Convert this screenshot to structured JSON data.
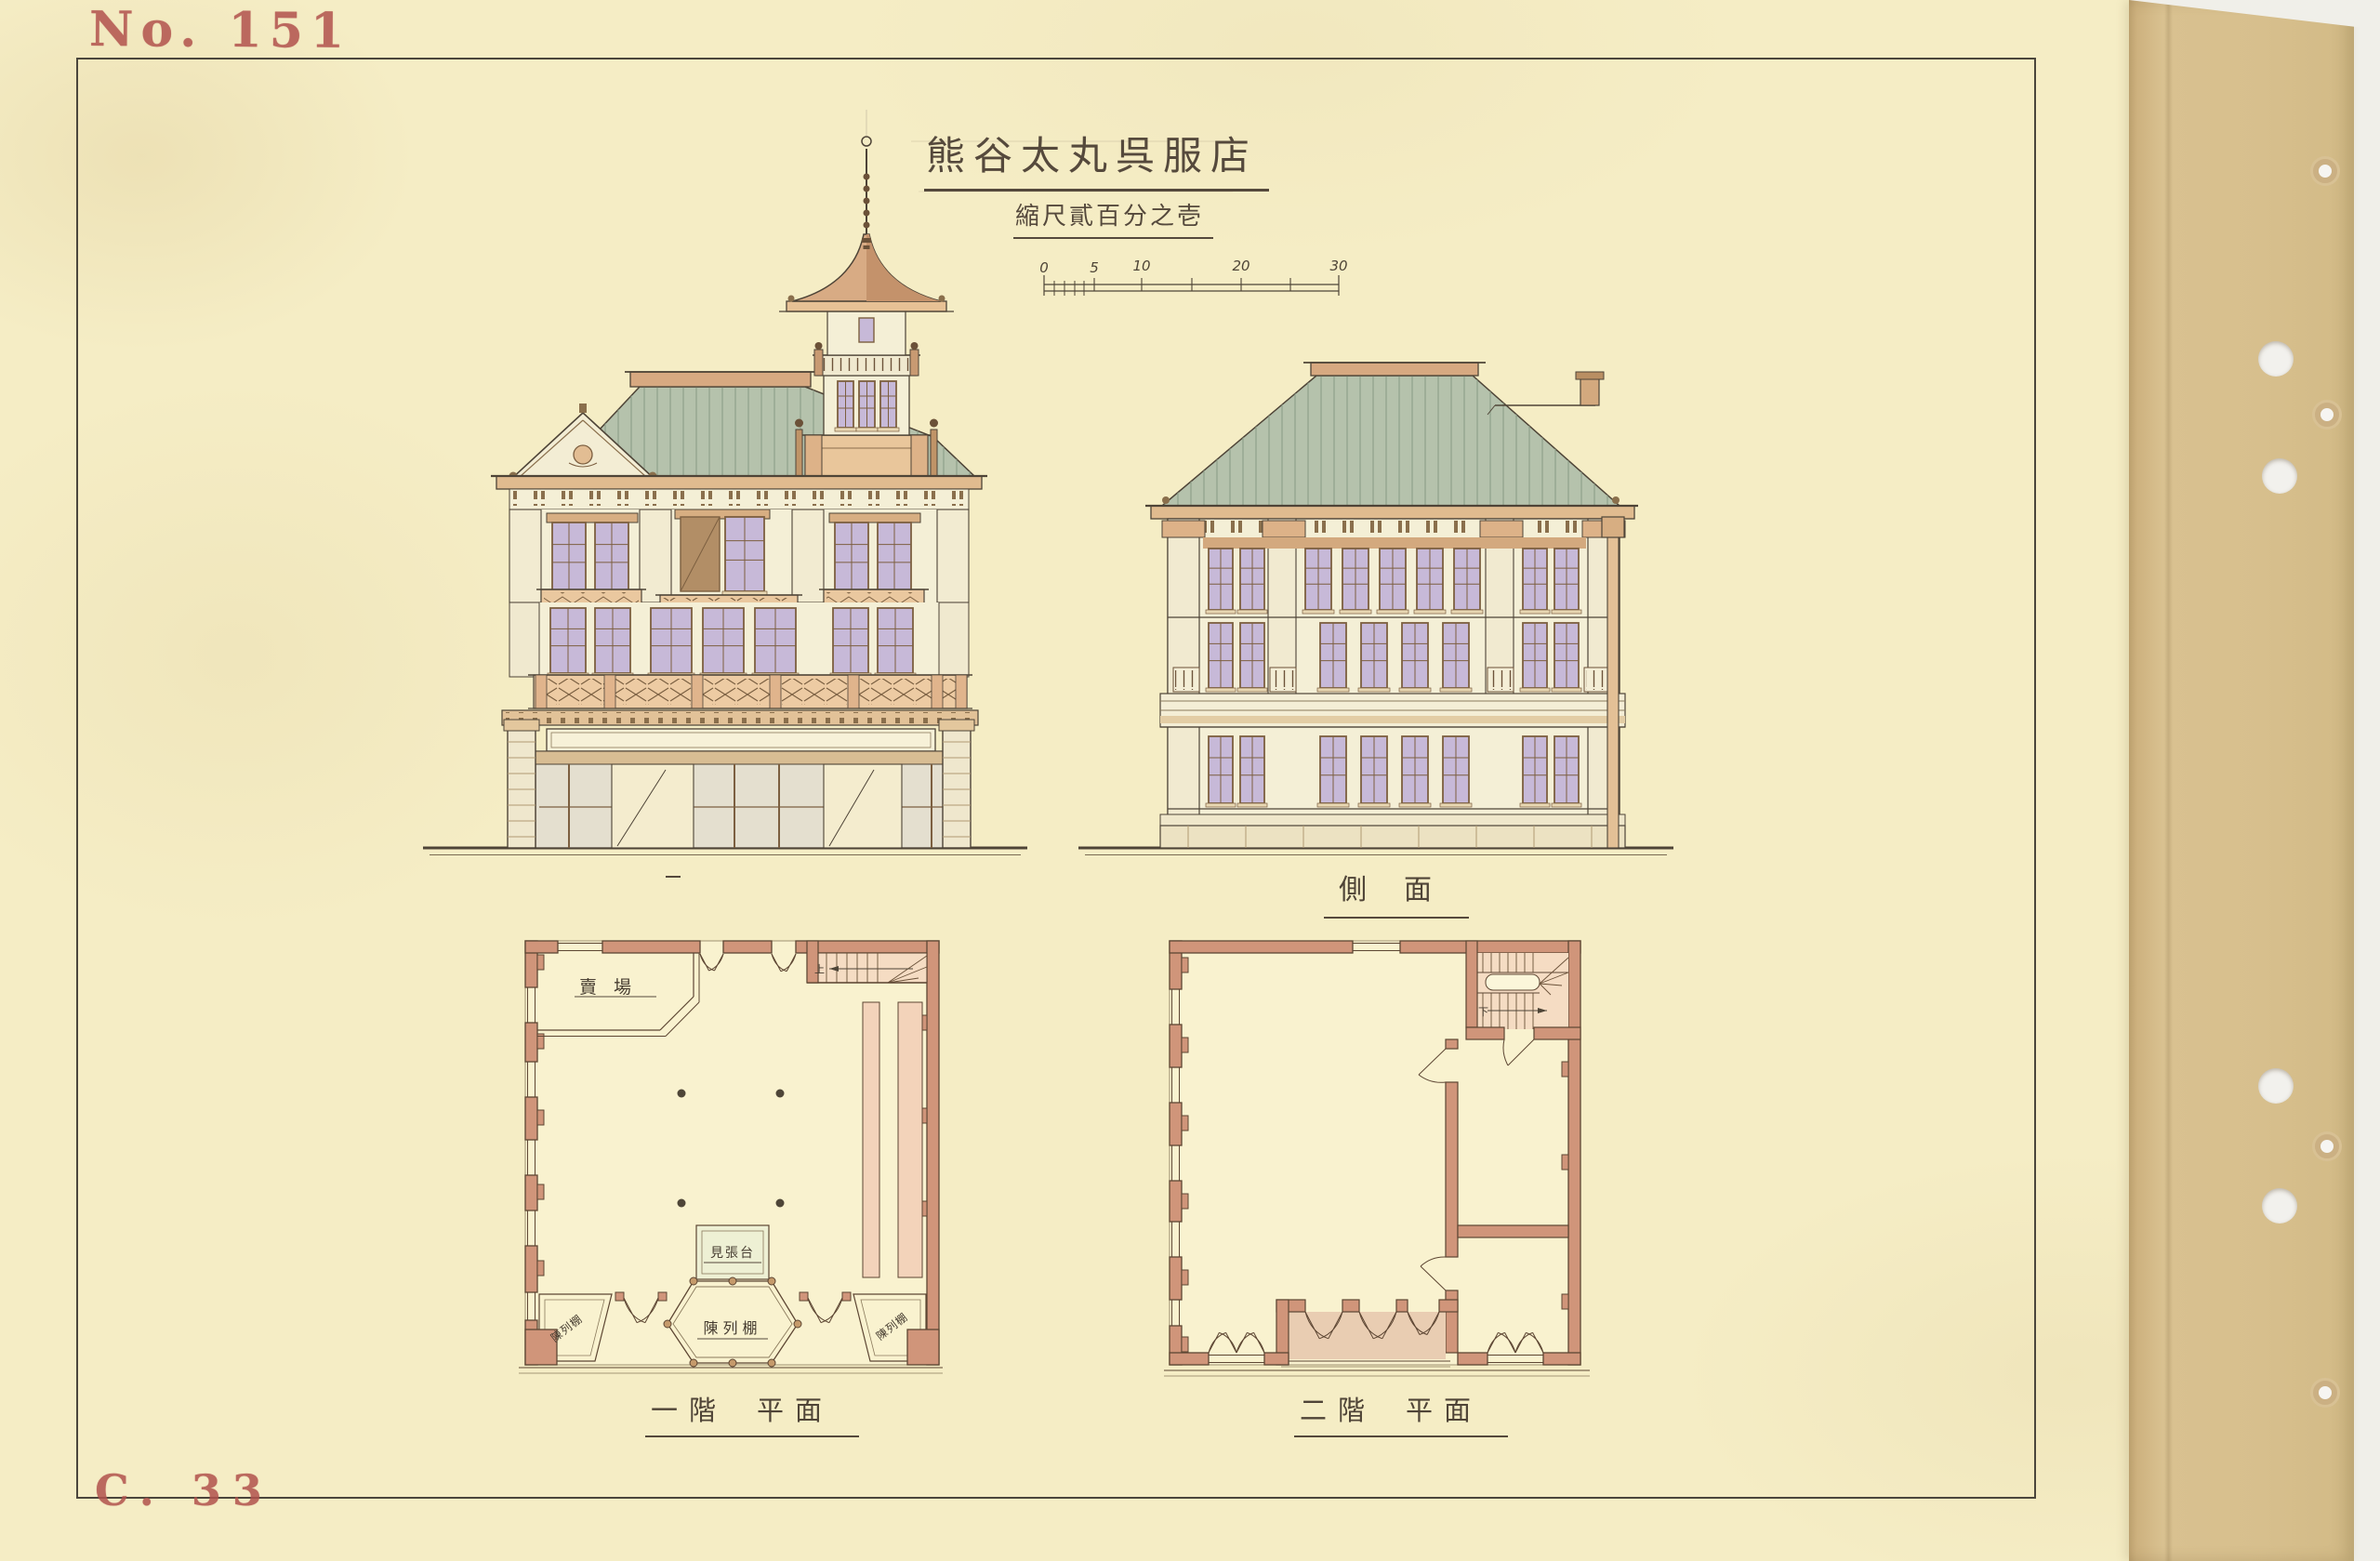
{
  "sheet": {
    "stamp_number": "No. 151",
    "catalog_number": "C. 33",
    "title": "熊谷太丸呉服店",
    "scale_note": "縮尺貳百分之壱"
  },
  "scale_bar": {
    "ticks": [
      "0",
      "5",
      "10",
      "20",
      "30"
    ]
  },
  "drawings": {
    "front_elevation": {
      "label": "正面"
    },
    "side_elevation": {
      "label": "側面"
    },
    "first_floor_plan": {
      "floor": "一階",
      "word": "平面"
    },
    "second_floor_plan": {
      "floor": "二階",
      "word": "平面"
    }
  },
  "plan_rooms": {
    "sales_floor": "賣場",
    "lookout_stand": "見張台",
    "display_case": "陳列棚",
    "display_case_left": "陳列棚",
    "display_case_right": "陳列棚",
    "stair_up": "上",
    "stair_down": "下"
  },
  "colors": {
    "paper": "#f5edc5",
    "binding": "#d9c190",
    "background": "#f0efe9",
    "ink": "#4e4437",
    "stamp_red": "#b2524d",
    "roof_green": "#b5c2ac",
    "ridge_tan": "#d7a981",
    "eave_tan": "#e0bb8f",
    "wall": "#f4efd6",
    "trim_tan": "#ddb288",
    "frame": "#7c5f40",
    "glass": "#c7b9d8",
    "shutter": "#b28e66",
    "plan_wall": "#d0957a",
    "plan_line": "#5d4633",
    "stair": "#f5dcc3",
    "counter": "#f3d3ba",
    "balcony": "#e9cdb2",
    "case_pale": "#eef0d4"
  }
}
